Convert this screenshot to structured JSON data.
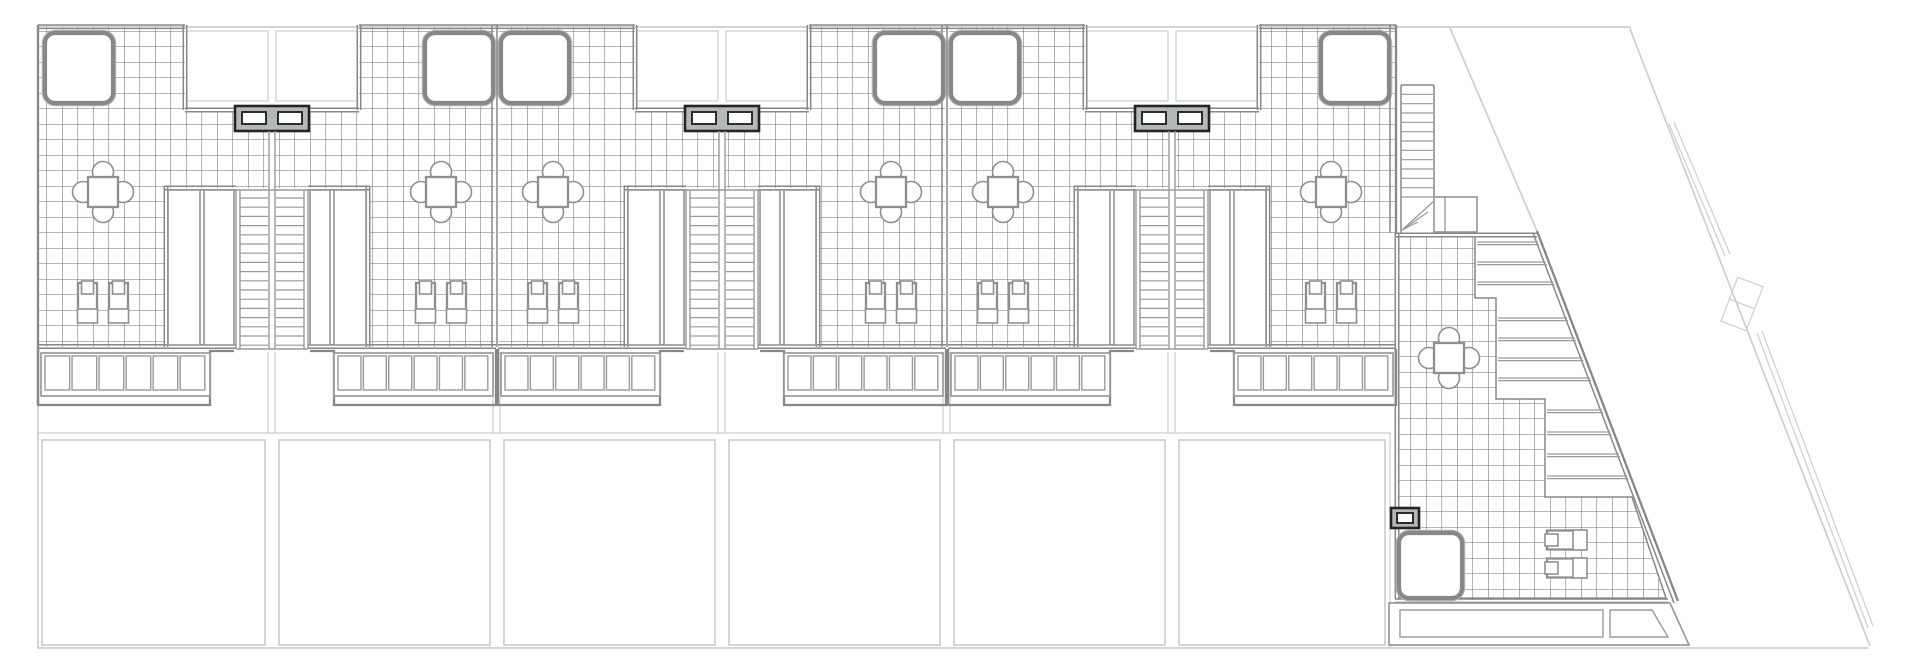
{
  "meta": {
    "document_type": "architectural-cad-drawing",
    "view": "roof-terrace-plan",
    "visible_text": "",
    "units_count": 7
  },
  "palette": {
    "background": "#ffffff",
    "site_lines": "#cbcfcf",
    "walls": "#878787",
    "walls_soft": "#b0b4b4",
    "tile_grid": "#6f6f6f",
    "fixtures": "#9a9a9a",
    "furniture": "#8f8f8f",
    "vent_frame": "#242424",
    "vent_fill": "#b4b8b8"
  },
  "levels": {
    "top_wall": 25,
    "notch_wall": 110,
    "band_wall": 188,
    "grid_bottom": 345,
    "stair_top": 198,
    "stair_bottom": 347,
    "slat_top": 353,
    "slat_bottom": 396,
    "outline_bottom": 405,
    "plots_top": 440,
    "plots_bottom": 645,
    "site_bottom": 648,
    "site_top": 27
  },
  "row_units": [
    {
      "id": "house-1",
      "left": 37,
      "right": 272,
      "stair_party": 272,
      "skylight_side": "left",
      "end": "left"
    },
    {
      "id": "house-2",
      "left": 272,
      "right": 497,
      "stair_party": 272,
      "skylight_side": "right",
      "end": null
    },
    {
      "id": "house-3",
      "left": 497,
      "right": 722,
      "stair_party": 722,
      "skylight_side": "left",
      "end": null
    },
    {
      "id": "house-4",
      "left": 722,
      "right": 947,
      "stair_party": 722,
      "skylight_side": "right",
      "end": null
    },
    {
      "id": "house-5",
      "left": 947,
      "right": 1172,
      "stair_party": 1172,
      "skylight_side": "left",
      "end": null
    },
    {
      "id": "house-6",
      "left": 1172,
      "right": 1397,
      "stair_party": 1172,
      "skylight_side": "right",
      "end": "right"
    }
  ],
  "stair_parties": [
    272,
    722,
    1172
  ],
  "skylight_parties": [
    497,
    947
  ],
  "plots_x": [
    [
      42,
      265
    ],
    [
      279,
      490
    ],
    [
      504,
      715
    ],
    [
      729,
      940
    ],
    [
      954,
      1165
    ],
    [
      1179,
      1385
    ]
  ],
  "tile_size": 15.5,
  "skylight": {
    "w": 68,
    "h": 70,
    "y": 33,
    "inset_end": 8,
    "inset_party": 4
  },
  "furniture": {
    "table_offset_end": 66,
    "table_offset": 56,
    "table_cy": 192,
    "loungers_cy": 304,
    "lounger_gap": 15.5
  },
  "vent_double": {
    "w": 74,
    "h": 25,
    "y": 106
  },
  "corner_unit": {
    "id": "house-7-corner",
    "left_wall_x": 1397,
    "top_wall_y": 233,
    "ext_stair": {
      "x1": 1401,
      "x2": 1434,
      "y1": 85,
      "y2": 197,
      "treads": 12
    },
    "landing": {
      "x": 1434,
      "y": 197,
      "w": 43,
      "h": 35
    },
    "diagonal": {
      "x1": 1537,
      "y1": 231,
      "x2": 1678,
      "y2": 601
    },
    "zigzag_x": [
      1475,
      1496,
      1545
    ],
    "zigzag_y": [
      237,
      298,
      399,
      497
    ],
    "inner_diag": {
      "x1": 1632,
      "y1": 497,
      "x2": 1666,
      "y2": 598
    },
    "tread_ys": [
      242,
      262,
      282,
      318,
      338,
      358,
      378,
      410,
      432,
      454,
      476
    ],
    "table": {
      "cx": 1449,
      "cy": 358
    },
    "loungers": {
      "cx": 1568,
      "cy1": 540,
      "cy2": 568
    },
    "vent_single": {
      "x": 1391,
      "y": 508,
      "w": 28,
      "h": 20
    },
    "skylight": {
      "x": 1399,
      "y": 533,
      "w": 63,
      "h": 65
    },
    "bottom_wall_y": 599,
    "pergola": {
      "poly": [
        [
          1389,
          603
        ],
        [
          1670,
          603
        ],
        [
          1689,
          645
        ],
        [
          1389,
          645
        ]
      ],
      "panel": [
        1400,
        610,
        203,
        27
      ],
      "panel_trap": [
        [
          1610,
          610
        ],
        [
          1652,
          610
        ],
        [
          1668,
          637
        ],
        [
          1610,
          637
        ]
      ]
    }
  },
  "site": {
    "top_line": [
      37,
      27,
      1630,
      27
    ],
    "bottom_line": [
      37,
      648,
      1868,
      648
    ],
    "left_line": [
      38,
      27,
      38,
      648
    ],
    "right_plot_line": [
      1390,
      433,
      1390,
      648
    ],
    "inner_diag": [
      1450,
      28,
      1537,
      231
    ],
    "outer_diag": [
      1630,
      29,
      1870,
      646
    ],
    "outer_diag_tick": [
      1630,
      27,
      1634,
      40
    ],
    "wall_segment": [
      1669,
      124,
      1725,
      256
    ],
    "gate": {
      "cx": 1742,
      "cy": 304,
      "w": 27,
      "h": 47,
      "rot": 21
    },
    "double_segment": [
      1757,
      333,
      1868,
      628
    ]
  },
  "legend_names": {
    "skylight": "roof-skylight",
    "dining_set": "dining-table-with-chairs",
    "sun_lounger": "sun-lounger",
    "stair": "stair-flight",
    "vent": "ac-vent-unit",
    "rooflight": "rooflight-strip",
    "pergola": "pergola-slats",
    "plot": "ground-plot"
  }
}
